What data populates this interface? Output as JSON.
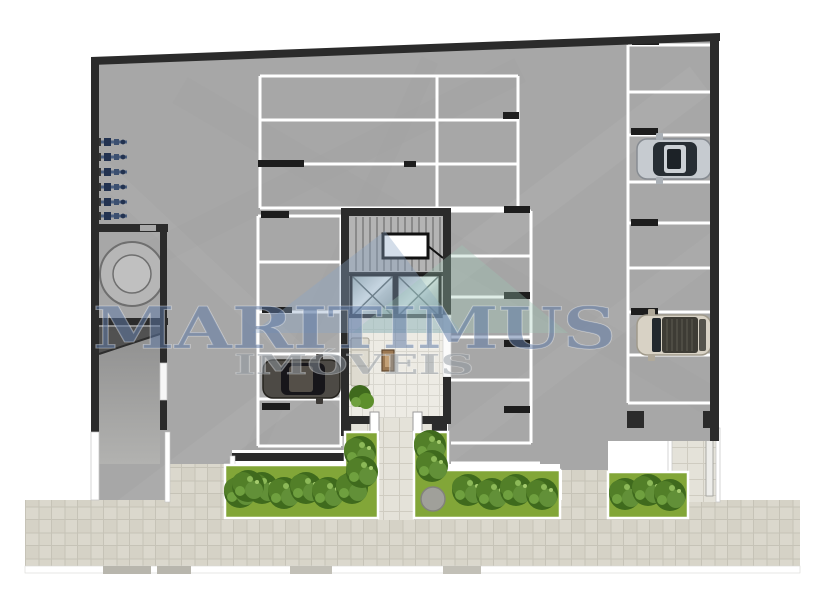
{
  "watermark": {
    "brand": "MARITIMUS",
    "tagline": "IMÓVEIS"
  },
  "legend": {
    "parking_stalls_top_grid": 6,
    "parking_stalls_left_column": 5,
    "parking_stalls_right_of_core": 5,
    "parking_stalls_right_column": 8,
    "cars": [
      "dark-gray-car",
      "silver-car",
      "beige-car"
    ],
    "elevators": 2,
    "stair_flights": 1,
    "water_meters": 6,
    "cistern": 1,
    "planters": 3
  },
  "colors": {
    "floor_marble": "#a7a7a7",
    "walls": "#2b2b2b",
    "stall_lines": "#ffffff",
    "sidewalk": "#dbd8cd",
    "grass": "#82a638",
    "foliage": "#3f6a1d",
    "watermark_text": "#5e79a4",
    "watermark_tagline": "#8f979f",
    "logo_blue": "#8ca6c6",
    "logo_green": "#9ec9b6"
  }
}
